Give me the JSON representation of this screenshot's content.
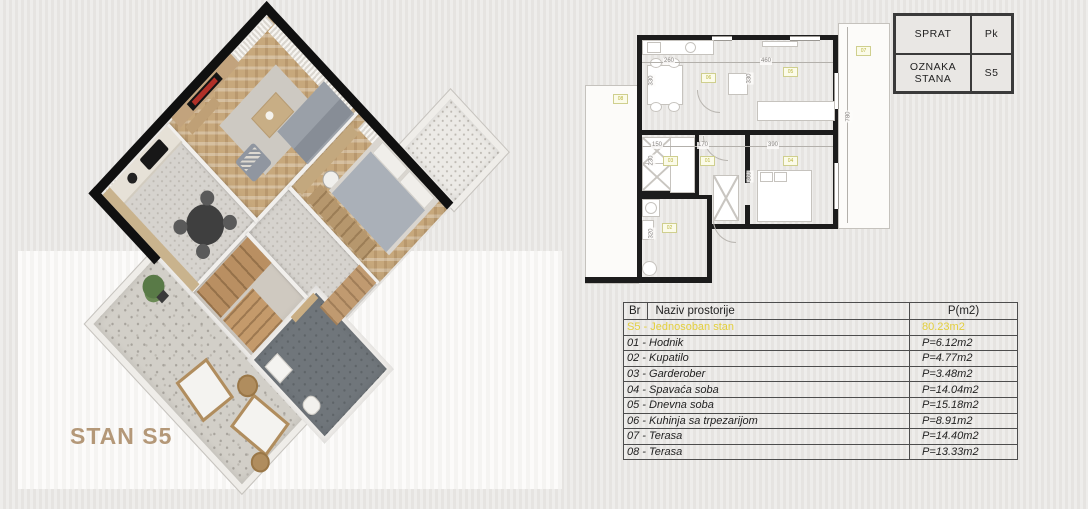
{
  "plan3d": {
    "title": "STAN S5",
    "title_color": "#b49878"
  },
  "info_box": {
    "row1_label": "SPRAT",
    "row1_value": "Pk",
    "row2_label": "OZNAKA STANA",
    "row2_value": "S5"
  },
  "area_table": {
    "header": {
      "br": "Br",
      "name": "Naziv prostorije",
      "area": "P(m2)"
    },
    "summary": {
      "name": "S5 - Jednosoban stan",
      "area": "80.23m2"
    },
    "accent_color": "#e3cf3d",
    "rows": [
      {
        "name": "01 - Hodnik",
        "area": "P=6.12m2"
      },
      {
        "name": "02 - Kupatilo",
        "area": "P=4.77m2"
      },
      {
        "name": "03 - Garderober",
        "area": "P=3.48m2"
      },
      {
        "name": "04 - Spavaća soba",
        "area": "P=14.04m2"
      },
      {
        "name": "05 - Dnevna soba",
        "area": "P=15.18m2"
      },
      {
        "name": "06 - Kuhinja sa trpezarijom",
        "area": "P=8.91m2"
      },
      {
        "name": "07 - Terasa",
        "area": "P=14.40m2"
      },
      {
        "name": "08 - Terasa",
        "area": "P=13.33m2"
      }
    ]
  },
  "plan2d": {
    "dims": {
      "kitchen_w": "260",
      "living_w": "460",
      "kitchen_d": "330",
      "living_d": "330",
      "terrace_right_h": "780",
      "garderober_w": "150",
      "hodnik_w": "170",
      "bedroom_w": "390",
      "garderober_d": "230",
      "bedroom_d": "360",
      "bathroom_d": "320"
    },
    "badges": {
      "kitchen": "06",
      "living": "05",
      "bedroom": "04",
      "garderober": "03",
      "hodnik": "01",
      "bathroom": "02",
      "terrace_right": "07",
      "terrace_left": "08"
    }
  }
}
